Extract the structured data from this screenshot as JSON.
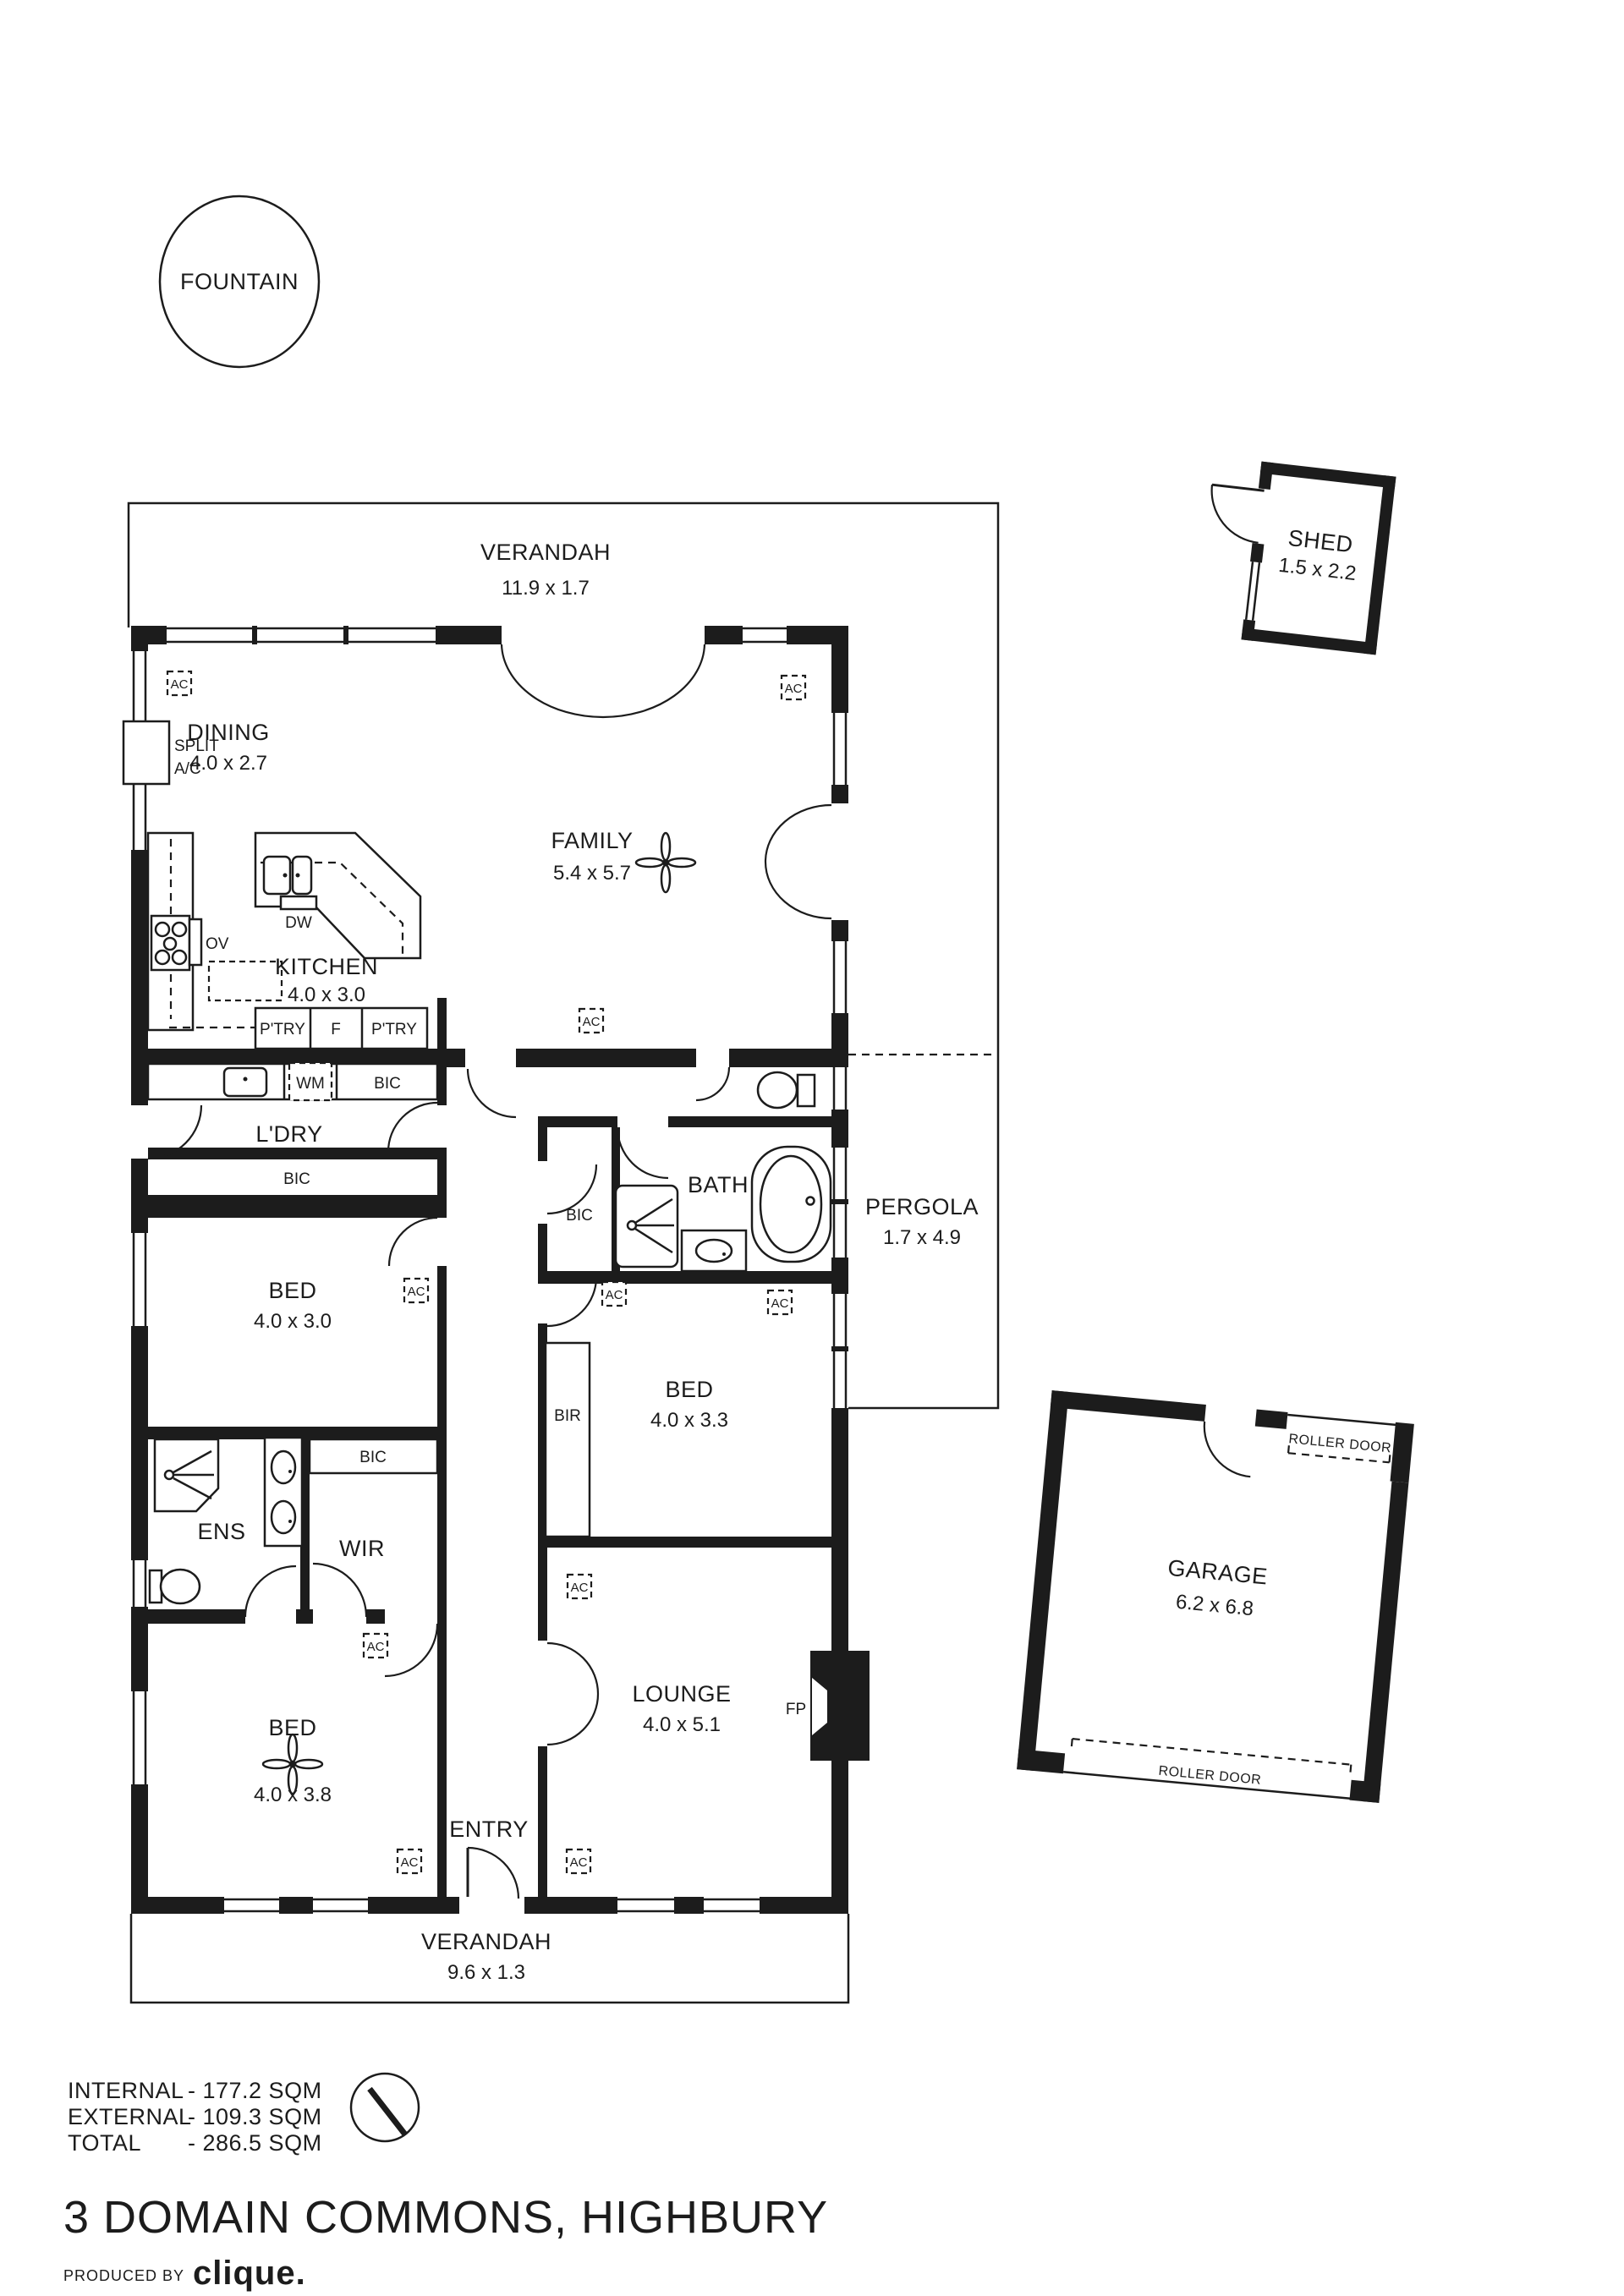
{
  "colors": {
    "ink": "#1c1c1c",
    "bg": "#ffffff"
  },
  "labels": {
    "fountain": "FOUNTAIN"
  },
  "outdoor": {
    "verandah_top": {
      "name": "VERANDAH",
      "dims": "11.9 x 1.7"
    },
    "verandah_bottom": {
      "name": "VERANDAH",
      "dims": "9.6 x 1.3"
    },
    "pergola": {
      "name": "PERGOLA",
      "dims": "1.7 x 4.9"
    },
    "shed": {
      "name": "SHED",
      "dims": "1.5 x 2.2"
    },
    "garage": {
      "name": "GARAGE",
      "dims": "6.2 x 6.8",
      "roller_door": "ROLLER DOOR"
    }
  },
  "rooms": {
    "dining": {
      "name": "DINING",
      "dims": "4.0 x 2.7"
    },
    "family": {
      "name": "FAMILY",
      "dims": "5.4 x 5.7"
    },
    "kitchen": {
      "name": "KITCHEN",
      "dims": "4.0 x 3.0"
    },
    "laundry": {
      "name": "L'DRY"
    },
    "bath": {
      "name": "BATH"
    },
    "bed1": {
      "name": "BED",
      "dims": "4.0 x 3.0"
    },
    "bed2": {
      "name": "BED",
      "dims": "4.0 x 3.3"
    },
    "bed3": {
      "name": "BED",
      "dims": "4.0 x 3.8"
    },
    "ens": {
      "name": "ENS"
    },
    "wir": {
      "name": "WIR"
    },
    "lounge": {
      "name": "LOUNGE",
      "dims": "4.0 x 5.1"
    },
    "entry": {
      "name": "ENTRY"
    }
  },
  "fixtures": {
    "ac": "AC",
    "split_ac_1": "SPLIT",
    "split_ac_2": "A/C",
    "oven": "OV",
    "dishwasher": "DW",
    "washing_machine": "WM",
    "fridge": "F",
    "pantry": "P'TRY",
    "bic": "BIC",
    "bir": "BIR",
    "fireplace": "FP"
  },
  "areas": {
    "internal": {
      "label": "INTERNAL",
      "value": "-  177.2 SQM"
    },
    "external": {
      "label": "EXTERNAL",
      "value": "-  109.3 SQM"
    },
    "total": {
      "label": "TOTAL",
      "value": "-  286.5 SQM"
    }
  },
  "footer": {
    "title": "3 DOMAIN COMMONS, HIGHBURY",
    "produced_by": "PRODUCED BY",
    "brand": "clique."
  }
}
